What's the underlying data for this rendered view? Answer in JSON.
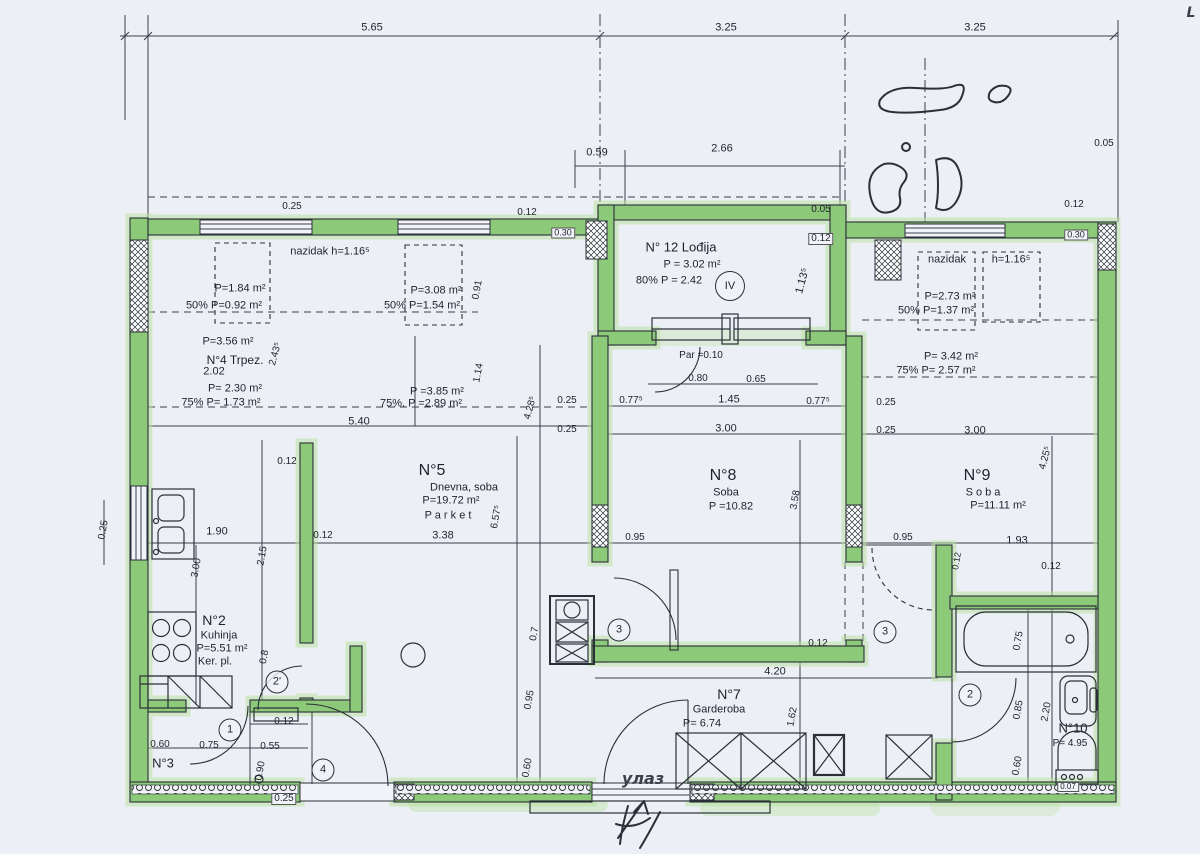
{
  "colors": {
    "paper": "#edeff6",
    "line": "#3a3f49",
    "wall_fill": "#8cc979",
    "wall_edge": "#2b3038",
    "highlight": "#b9e3a2",
    "text": "#1e222c"
  },
  "rooms": [
    {
      "number": "N°2",
      "name": "Kuhinja",
      "area": "P=5.51 m²",
      "floor": "Ker. pl."
    },
    {
      "number": "N°3",
      "name": "",
      "area": ""
    },
    {
      "number": "N°4",
      "name": "Trpez.",
      "area": "P=3.56 m²",
      "area_extra": "P= 2.30 m² / 75% P= 1.73 m²"
    },
    {
      "number": "N°5",
      "name": "Dnevna soba",
      "area": "P=19.72 m²",
      "floor": "Parket"
    },
    {
      "number": "N°7",
      "name": "Garderoba",
      "area": "P= 6.74"
    },
    {
      "number": "N°8",
      "name": "Soba",
      "area": "P =10.82"
    },
    {
      "number": "N°9",
      "name": "Soba",
      "area": "P=11.11 m²"
    },
    {
      "number": "N°10",
      "name": "",
      "area": "P= 4.95"
    },
    {
      "number": "N°12",
      "name": "Lođija",
      "area": "P = 3.02 m²",
      "area_extra": "80% P = 2.42"
    }
  ],
  "labels": [
    {
      "t": "5.65",
      "x": 372,
      "y": 28,
      "n": "dim"
    },
    {
      "t": "3.25",
      "x": 726,
      "y": 28,
      "n": "dim"
    },
    {
      "t": "3.25",
      "x": 975,
      "y": 28,
      "n": "dim"
    },
    {
      "t": "L",
      "x": 1191,
      "y": 13,
      "n": "hand-mark",
      "hw": true,
      "s": 14
    },
    {
      "t": "0.59",
      "x": 597,
      "y": 153,
      "n": "dim"
    },
    {
      "t": "2.66",
      "x": 722,
      "y": 149,
      "n": "dim"
    },
    {
      "t": "0.05",
      "x": 1104,
      "y": 144,
      "n": "dim",
      "s": 10
    },
    {
      "t": "0.12",
      "x": 1074,
      "y": 205,
      "n": "dim",
      "s": 10
    },
    {
      "t": "0.05",
      "x": 821,
      "y": 210,
      "n": "dim",
      "s": 10
    },
    {
      "t": "0.12",
      "x": 821,
      "y": 239,
      "n": "dim",
      "s": 10,
      "bg": true
    },
    {
      "t": "0.25",
      "x": 292,
      "y": 207,
      "n": "dim",
      "s": 10
    },
    {
      "t": "0.12",
      "x": 527,
      "y": 213,
      "n": "dim",
      "s": 10
    },
    {
      "t": "0.30",
      "x": 563,
      "y": 233,
      "n": "dim",
      "s": 9,
      "bg": true
    },
    {
      "t": "0.30",
      "x": 1076,
      "y": 235,
      "n": "dim",
      "s": 9,
      "bg": true
    },
    {
      "t": "N° 12 Lođija",
      "x": 681,
      "y": 247,
      "n": "room12-title",
      "s": 13
    },
    {
      "t": "P = 3.02 m²",
      "x": 692,
      "y": 265,
      "n": "room12-area"
    },
    {
      "t": "80% P = 2.42",
      "x": 669,
      "y": 281,
      "n": "room12-area-80"
    },
    {
      "t": "1.13⁵",
      "x": 803,
      "y": 281,
      "r": -75,
      "n": "dim"
    },
    {
      "t": "IV",
      "x": 730,
      "y": 286,
      "c": true,
      "d": 28,
      "n": "axis-mark-IV"
    },
    {
      "t": "nazidak  h=1.16⁵",
      "x": 330,
      "y": 252,
      "n": "parapet-note-left"
    },
    {
      "t": "P=1.84 m²",
      "x": 240,
      "y": 289,
      "n": "parapet-area"
    },
    {
      "t": "50%  P=0.92 m²",
      "x": 224,
      "y": 306,
      "n": "parapet-area-50"
    },
    {
      "t": "P=3.08 m²",
      "x": 436,
      "y": 291,
      "n": "parapet-area"
    },
    {
      "t": "50% P=1.54 m²",
      "x": 422,
      "y": 306,
      "n": "parapet-area-50"
    },
    {
      "t": "nazidak",
      "x": 947,
      "y": 260,
      "n": "parapet-note-right"
    },
    {
      "t": "h=1.16⁵",
      "x": 1011,
      "y": 260,
      "n": "parapet-note-right-h"
    },
    {
      "t": "P=2.73 m²",
      "x": 950,
      "y": 297,
      "n": "parapet-area"
    },
    {
      "t": "50%  P=1.37 m²",
      "x": 936,
      "y": 311,
      "n": "parapet-area-50"
    },
    {
      "t": "P=3.56 m²",
      "x": 228,
      "y": 342,
      "n": "room4-area"
    },
    {
      "t": "2.43⁵",
      "x": 276,
      "y": 354,
      "r": -75,
      "n": "dim",
      "s": 10
    },
    {
      "t": "N°4 Trpez.",
      "x": 235,
      "y": 360,
      "n": "room4-title",
      "s": 12
    },
    {
      "t": "2.02",
      "x": 214,
      "y": 372,
      "n": "dim"
    },
    {
      "t": "P= 2.30 m²",
      "x": 235,
      "y": 389,
      "n": "room4-area-2"
    },
    {
      "t": "75%  P= 1.73 m²",
      "x": 221,
      "y": 403,
      "n": "room4-area-75"
    },
    {
      "t": "P =3.85 m²",
      "x": 437,
      "y": 392,
      "n": "area-note"
    },
    {
      "t": "75%. P =2.89 m²",
      "x": 421,
      "y": 404,
      "n": "area-note-75"
    },
    {
      "t": "P= 3.42 m²",
      "x": 951,
      "y": 357,
      "n": "area-note"
    },
    {
      "t": "75%  P= 2.57 m²",
      "x": 936,
      "y": 371,
      "n": "area-note-75"
    },
    {
      "t": "0.91",
      "x": 478,
      "y": 290,
      "r": -80,
      "n": "dim",
      "s": 10
    },
    {
      "t": "1.14",
      "x": 479,
      "y": 373,
      "r": -80,
      "n": "dim",
      "s": 10
    },
    {
      "t": "5.40",
      "x": 359,
      "y": 422,
      "n": "dim"
    },
    {
      "t": "4.28⁵",
      "x": 531,
      "y": 408,
      "r": -75,
      "n": "dim",
      "s": 10
    },
    {
      "t": "Par =0.10",
      "x": 701,
      "y": 356,
      "n": "note-parquet",
      "s": 10
    },
    {
      "t": "0.80",
      "x": 698,
      "y": 379,
      "n": "dim",
      "s": 10
    },
    {
      "t": "0.65",
      "x": 756,
      "y": 380,
      "n": "dim",
      "s": 10
    },
    {
      "t": "0.77⁵",
      "x": 631,
      "y": 401,
      "n": "dim",
      "s": 10
    },
    {
      "t": "1.45",
      "x": 729,
      "y": 400,
      "n": "dim"
    },
    {
      "t": "0.77⁵",
      "x": 818,
      "y": 402,
      "n": "dim",
      "s": 10
    },
    {
      "t": "3.00",
      "x": 726,
      "y": 429,
      "n": "dim"
    },
    {
      "t": "0.25",
      "x": 567,
      "y": 401,
      "n": "dim",
      "s": 10
    },
    {
      "t": "0.25",
      "x": 567,
      "y": 430,
      "n": "dim",
      "s": 10
    },
    {
      "t": "0.25",
      "x": 886,
      "y": 403,
      "n": "dim",
      "s": 10
    },
    {
      "t": "0.25",
      "x": 886,
      "y": 431,
      "n": "dim",
      "s": 10
    },
    {
      "t": "3.00",
      "x": 975,
      "y": 431,
      "n": "dim"
    },
    {
      "t": "4.25⁵",
      "x": 1046,
      "y": 458,
      "r": -75,
      "n": "dim",
      "s": 10
    },
    {
      "t": "N°5",
      "x": 432,
      "y": 471,
      "n": "room5-number",
      "s": 16
    },
    {
      "t": "Dnevna, soba",
      "x": 464,
      "y": 488,
      "n": "room5-name"
    },
    {
      "t": "P=19.72 m²",
      "x": 451,
      "y": 501,
      "n": "room5-area"
    },
    {
      "t": "P a r k e t",
      "x": 448,
      "y": 516,
      "n": "room5-floor"
    },
    {
      "t": "6.57⁵",
      "x": 497,
      "y": 517,
      "r": -80,
      "n": "dim",
      "s": 10
    },
    {
      "t": "3.38",
      "x": 443,
      "y": 536,
      "n": "dim"
    },
    {
      "t": "0.95",
      "x": 635,
      "y": 538,
      "n": "dim",
      "s": 10
    },
    {
      "t": "0.12",
      "x": 287,
      "y": 462,
      "n": "dim",
      "s": 10
    },
    {
      "t": "1.90",
      "x": 217,
      "y": 532,
      "n": "dim"
    },
    {
      "t": "0.12",
      "x": 323,
      "y": 536,
      "n": "dim",
      "s": 10
    },
    {
      "t": "2.15",
      "x": 263,
      "y": 556,
      "r": -80,
      "n": "dim",
      "s": 10
    },
    {
      "t": "3.00",
      "x": 197,
      "y": 568,
      "r": -80,
      "n": "dim",
      "s": 10
    },
    {
      "t": "0.25",
      "x": 104,
      "y": 530,
      "r": -80,
      "n": "dim",
      "s": 10
    },
    {
      "t": "N°8",
      "x": 723,
      "y": 476,
      "n": "room8-number",
      "s": 16
    },
    {
      "t": "Soba",
      "x": 726,
      "y": 493,
      "n": "room8-name"
    },
    {
      "t": "P =10.82",
      "x": 731,
      "y": 507,
      "n": "room8-area"
    },
    {
      "t": "3.58",
      "x": 796,
      "y": 500,
      "r": -80,
      "n": "dim",
      "s": 10
    },
    {
      "t": "N°9",
      "x": 977,
      "y": 476,
      "n": "room9-number",
      "s": 16
    },
    {
      "t": "S o b a",
      "x": 983,
      "y": 493,
      "n": "room9-name"
    },
    {
      "t": "P=11.11 m²",
      "x": 998,
      "y": 506,
      "n": "room9-area"
    },
    {
      "t": "0.95",
      "x": 903,
      "y": 538,
      "n": "dim",
      "s": 10
    },
    {
      "t": "1.93",
      "x": 1017,
      "y": 541,
      "n": "dim"
    },
    {
      "t": "0.12",
      "x": 957,
      "y": 561,
      "r": -80,
      "n": "dim",
      "s": 9
    },
    {
      "t": "0.12",
      "x": 1051,
      "y": 567,
      "n": "dim",
      "s": 10
    },
    {
      "t": "3",
      "x": 619,
      "y": 630,
      "c": true,
      "n": "door-mark-3"
    },
    {
      "t": "3",
      "x": 885,
      "y": 632,
      "c": true,
      "n": "door-mark-3"
    },
    {
      "t": "0.7",
      "x": 535,
      "y": 634,
      "r": -80,
      "n": "dim",
      "s": 10
    },
    {
      "t": "0.95",
      "x": 530,
      "y": 700,
      "r": -80,
      "n": "dim",
      "s": 10
    },
    {
      "t": "0.60",
      "x": 528,
      "y": 768,
      "r": -80,
      "n": "dim",
      "s": 10
    },
    {
      "t": "0.12",
      "x": 818,
      "y": 644,
      "n": "dim",
      "s": 10
    },
    {
      "t": "4.20",
      "x": 775,
      "y": 672,
      "n": "dim"
    },
    {
      "t": "N°7",
      "x": 729,
      "y": 694,
      "n": "room7-number",
      "s": 14
    },
    {
      "t": "Garderoba",
      "x": 719,
      "y": 710,
      "n": "room7-name"
    },
    {
      "t": "P= 6.74",
      "x": 702,
      "y": 724,
      "n": "room7-area"
    },
    {
      "t": "1.62",
      "x": 793,
      "y": 717,
      "r": -80,
      "n": "dim",
      "s": 10
    },
    {
      "t": "N°2",
      "x": 214,
      "y": 620,
      "n": "room2-number",
      "s": 14
    },
    {
      "t": "Kuhinja",
      "x": 219,
      "y": 636,
      "n": "room2-name"
    },
    {
      "t": "P=5.51 m²",
      "x": 222,
      "y": 649,
      "n": "room2-area"
    },
    {
      "t": "Ker. pl.",
      "x": 215,
      "y": 662,
      "n": "room2-floor"
    },
    {
      "t": "0.8",
      "x": 265,
      "y": 657,
      "r": -80,
      "n": "dim",
      "s": 10
    },
    {
      "t": "2'",
      "x": 277,
      "y": 682,
      "c": true,
      "n": "door-mark-2p"
    },
    {
      "t": "0.60",
      "x": 160,
      "y": 745,
      "n": "dim",
      "s": 10
    },
    {
      "t": "0.75",
      "x": 209,
      "y": 746,
      "n": "dim",
      "s": 10
    },
    {
      "t": "0.55",
      "x": 270,
      "y": 747,
      "n": "dim",
      "s": 10
    },
    {
      "t": "0.12",
      "x": 284,
      "y": 722,
      "n": "dim",
      "s": 10
    },
    {
      "t": "N°3",
      "x": 163,
      "y": 763,
      "n": "room3-number",
      "s": 13
    },
    {
      "t": "1",
      "x": 230,
      "y": 730,
      "c": true,
      "n": "door-mark-1"
    },
    {
      "t": "0.90",
      "x": 261,
      "y": 771,
      "r": -80,
      "n": "dim",
      "s": 10
    },
    {
      "t": "0.25",
      "x": 284,
      "y": 799,
      "n": "dim",
      "s": 10,
      "bg": true
    },
    {
      "t": "4",
      "x": 323,
      "y": 770,
      "c": true,
      "n": "door-mark-4"
    },
    {
      "t": "0.75",
      "x": 1019,
      "y": 641,
      "r": -80,
      "n": "dim",
      "s": 10
    },
    {
      "t": "0.85",
      "x": 1019,
      "y": 710,
      "r": -80,
      "n": "dim",
      "s": 10
    },
    {
      "t": "2.20",
      "x": 1047,
      "y": 712,
      "r": -80,
      "n": "dim",
      "s": 10
    },
    {
      "t": "0.60",
      "x": 1018,
      "y": 766,
      "r": -80,
      "n": "dim",
      "s": 10
    },
    {
      "t": "2",
      "x": 970,
      "y": 695,
      "c": true,
      "n": "door-mark-2"
    },
    {
      "t": "N°10",
      "x": 1073,
      "y": 728,
      "n": "room10-number",
      "s": 13
    },
    {
      "t": "P= 4.95",
      "x": 1070,
      "y": 744,
      "n": "room10-area",
      "s": 10
    },
    {
      "t": "0.07",
      "x": 1068,
      "y": 787,
      "n": "dim",
      "s": 8,
      "bg": true
    },
    {
      "t": "улаз",
      "x": 643,
      "y": 779,
      "n": "entrance-label",
      "hw": true,
      "s": 16
    }
  ]
}
